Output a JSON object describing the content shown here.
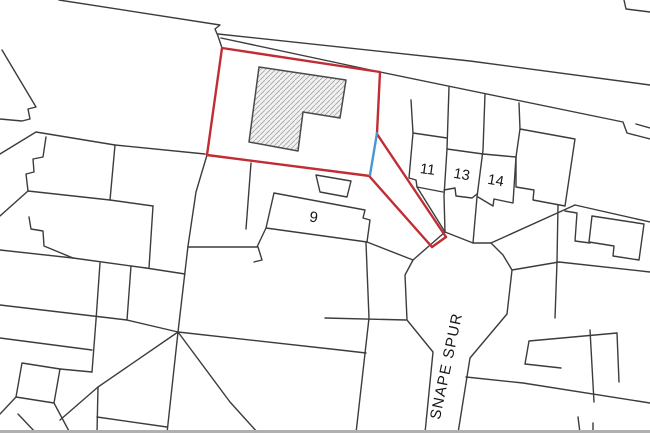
{
  "map": {
    "type": "site-location-plan",
    "width": 650,
    "height": 433,
    "colors": {
      "background": "#ffffff",
      "parcel_line": "#3c3c3c",
      "boundary_red": "#c02d33",
      "boundary_blue": "#4a97d2",
      "building_fill": "#f1f1f1",
      "building_hatch": "#a3a3a3",
      "building_outline": "#4a4a4a",
      "label_color": "#151515",
      "bottom_strip": "#b0b0b0"
    },
    "labels": [
      {
        "name": "house-number-9",
        "text": "9",
        "x": 313,
        "y": 222,
        "size": 15,
        "rot": 8,
        "spacing": 0
      },
      {
        "name": "house-number-11",
        "text": "11",
        "x": 427,
        "y": 174,
        "size": 14.5,
        "rot": 8,
        "spacing": 0
      },
      {
        "name": "house-number-13",
        "text": "13",
        "x": 461,
        "y": 179,
        "size": 14.5,
        "rot": 10,
        "spacing": 0
      },
      {
        "name": "house-number-14",
        "text": "14",
        "x": 495,
        "y": 185,
        "size": 14.5,
        "rot": 10,
        "spacing": 0
      },
      {
        "name": "street-name",
        "text": "SNAPE SPUR",
        "x": 451,
        "y": 367,
        "size": 15,
        "rot": -78,
        "spacing": 1.2
      }
    ],
    "red_boundary": [
      [
        [
          207,
          155
        ],
        [
          222,
          48
        ],
        [
          380,
          72
        ],
        [
          377,
          133
        ]
      ],
      [
        [
          370,
          176
        ],
        [
          207,
          155
        ]
      ],
      [
        [
          377,
          134
        ],
        [
          446,
          237
        ]
      ],
      [
        [
          370,
          177
        ],
        [
          432,
          247
        ]
      ],
      [
        [
          432,
          247
        ],
        [
          446,
          237
        ]
      ]
    ],
    "blue_segment": [
      [
        377,
        133
      ],
      [
        370,
        175
      ]
    ],
    "building": [
      [
        259,
        67
      ],
      [
        346,
        80
      ],
      [
        340,
        118
      ],
      [
        303,
        112
      ],
      [
        298,
        151
      ],
      [
        249,
        142
      ],
      [
        259,
        67
      ]
    ],
    "black_lines": [
      [
        [
          59,
          0
        ],
        [
          220,
          25
        ],
        [
          215,
          29
        ],
        [
          218,
          36
        ],
        [
          222,
          48
        ]
      ],
      [
        [
          218,
          34
        ],
        [
          470,
          61
        ],
        [
          650,
          85
        ]
      ],
      [
        [
          221,
          38
        ],
        [
          380,
          72
        ],
        [
          623,
          122
        ],
        [
          627,
          133
        ],
        [
          650,
          139
        ]
      ],
      [
        [
          636,
          124
        ],
        [
          650,
          128
        ]
      ],
      [
        [
          624,
          0
        ],
        [
          626,
          9
        ],
        [
          650,
          12
        ]
      ],
      [
        [
          2,
          50
        ],
        [
          36,
          107
        ],
        [
          28,
          109
        ],
        [
          30,
          119
        ],
        [
          22,
          121
        ],
        [
          0,
          119
        ]
      ],
      [
        [
          0,
          154
        ],
        [
          36,
          132
        ],
        [
          115,
          145
        ],
        [
          205,
          154
        ]
      ],
      [
        [
          207,
          155
        ],
        [
          196,
          192
        ],
        [
          188,
          246
        ],
        [
          178,
          332
        ],
        [
          167,
          433
        ]
      ],
      [
        [
          46,
          137
        ],
        [
          43,
          157
        ],
        [
          33,
          159
        ],
        [
          34,
          172
        ],
        [
          26,
          174
        ],
        [
          28,
          191
        ]
      ],
      [
        [
          28,
          191
        ],
        [
          110,
          200
        ],
        [
          153,
          206
        ]
      ],
      [
        [
          28,
          191
        ],
        [
          0,
          216
        ]
      ],
      [
        [
          153,
          206
        ],
        [
          149,
          268
        ]
      ],
      [
        [
          29,
          217
        ],
        [
          31,
          229
        ],
        [
          43,
          231
        ],
        [
          44,
          246
        ],
        [
          73,
          258
        ]
      ],
      [
        [
          0,
          250
        ],
        [
          73,
          258
        ]
      ],
      [
        [
          73,
          258
        ],
        [
          146,
          268
        ]
      ],
      [
        [
          146,
          268
        ],
        [
          185,
          274
        ]
      ],
      [
        [
          115,
          145
        ],
        [
          110,
          200
        ]
      ],
      [
        [
          100,
          263
        ],
        [
          96,
          320
        ]
      ],
      [
        [
          131,
          266
        ],
        [
          127,
          320
        ]
      ],
      [
        [
          0,
          305
        ],
        [
          127,
          320
        ]
      ],
      [
        [
          127,
          320
        ],
        [
          178,
          332
        ]
      ],
      [
        [
          96,
          320
        ],
        [
          92,
          372
        ]
      ],
      [
        [
          0,
          338
        ],
        [
          92,
          350
        ]
      ],
      [
        [
          178,
          332
        ],
        [
          98,
          387
        ],
        [
          60,
          420
        ]
      ],
      [
        [
          98,
          387
        ],
        [
          97,
          433
        ]
      ],
      [
        [
          178,
          332
        ],
        [
          230,
          402
        ],
        [
          258,
          433
        ]
      ],
      [
        [
          178,
          332
        ],
        [
          340,
          350
        ],
        [
          366,
          353
        ]
      ],
      [
        [
          22,
          363
        ],
        [
          60,
          369
        ],
        [
          54,
          403
        ],
        [
          16,
          397
        ],
        [
          22,
          363
        ]
      ],
      [
        [
          54,
          403
        ],
        [
          70,
          433
        ]
      ],
      [
        [
          16,
          397
        ],
        [
          0,
          414
        ]
      ],
      [
        [
          60,
          369
        ],
        [
          92,
          372
        ]
      ],
      [
        [
          18,
          414
        ],
        [
          36,
          433
        ]
      ],
      [
        [
          97,
          417
        ],
        [
          167,
          427
        ]
      ],
      [
        [
          251,
          163
        ],
        [
          246,
          229
        ]
      ],
      [
        [
          266,
          228
        ],
        [
          257,
          247
        ],
        [
          188,
          247
        ]
      ],
      [
        [
          258,
          247
        ],
        [
          262,
          260
        ],
        [
          254,
          262
        ]
      ],
      [
        [
          367,
          242
        ],
        [
          413,
          260
        ]
      ],
      [
        [
          366,
          243
        ],
        [
          369,
          318
        ],
        [
          356,
          433
        ]
      ],
      [
        [
          325,
          318
        ],
        [
          406,
          320
        ]
      ],
      [
        [
          413,
          260
        ],
        [
          405,
          275
        ],
        [
          407,
          320
        ],
        [
          433,
          352
        ],
        [
          425,
          433
        ]
      ],
      [
        [
          413,
          260
        ],
        [
          445,
          232
        ],
        [
          473,
          243
        ],
        [
          491,
          243
        ],
        [
          503,
          255
        ],
        [
          512,
          270
        ],
        [
          507,
          314
        ],
        [
          470,
          358
        ],
        [
          458,
          433
        ]
      ],
      [
        [
          449,
          87
        ],
        [
          447,
          149
        ],
        [
          444,
          196
        ],
        [
          445,
          232
        ]
      ],
      [
        [
          485,
          94
        ],
        [
          483,
          150
        ],
        [
          477,
          197
        ],
        [
          473,
          243
        ]
      ],
      [
        [
          411,
          100
        ],
        [
          413,
          133
        ]
      ],
      [
        [
          413,
          133
        ],
        [
          447,
          138
        ]
      ],
      [
        [
          413,
          133
        ],
        [
          409,
          178
        ],
        [
          416,
          180
        ],
        [
          417,
          187
        ],
        [
          443,
          192
        ]
      ],
      [
        [
          417,
          187
        ],
        [
          445,
          232
        ]
      ],
      [
        [
          447,
          149
        ],
        [
          483,
          154
        ]
      ],
      [
        [
          444,
          190
        ],
        [
          455,
          188
        ],
        [
          456,
          196
        ],
        [
          472,
          198
        ],
        [
          477,
          194
        ]
      ],
      [
        [
          483,
          154
        ],
        [
          516,
          157
        ]
      ],
      [
        [
          516,
          157
        ],
        [
          513,
          203
        ],
        [
          494,
          199
        ],
        [
          493,
          206
        ],
        [
          478,
          197
        ]
      ],
      [
        [
          516,
          157
        ],
        [
          520,
          129
        ],
        [
          575,
          139
        ],
        [
          565,
          206
        ],
        [
          533,
          200
        ],
        [
          534,
          190
        ],
        [
          516,
          187
        ],
        [
          516,
          157
        ]
      ],
      [
        [
          519,
          103
        ],
        [
          520,
          129
        ]
      ],
      [
        [
          491,
          243
        ],
        [
          575,
          205
        ]
      ],
      [
        [
          575,
          205
        ],
        [
          650,
          222
        ]
      ],
      [
        [
          565,
          211
        ],
        [
          577,
          213
        ],
        [
          575,
          241
        ],
        [
          590,
          243
        ]
      ],
      [
        [
          592,
          216
        ],
        [
          644,
          224
        ],
        [
          639,
          260
        ],
        [
          613,
          256
        ],
        [
          614,
          246
        ],
        [
          589,
          242
        ],
        [
          592,
          216
        ]
      ],
      [
        [
          512,
          270
        ],
        [
          559,
          262
        ],
        [
          650,
          272
        ]
      ],
      [
        [
          558,
          205
        ],
        [
          557,
          262
        ],
        [
          555,
          318
        ]
      ],
      [
        [
          466,
          377
        ],
        [
          523,
          383
        ],
        [
          650,
          403
        ]
      ],
      [
        [
          525,
          364
        ],
        [
          529,
          341
        ],
        [
          617,
          333
        ]
      ],
      [
        [
          590,
          330
        ],
        [
          594,
          402
        ]
      ],
      [
        [
          617,
          333
        ],
        [
          619,
          382
        ]
      ],
      [
        [
          525,
          364
        ],
        [
          561,
          368
        ]
      ],
      [
        [
          593,
          423
        ],
        [
          593,
          433
        ]
      ],
      [
        [
          578,
          417
        ],
        [
          580,
          433
        ]
      ],
      [
        [
          316,
          175
        ],
        [
          351,
          181
        ],
        [
          347,
          197
        ],
        [
          320,
          192
        ],
        [
          316,
          175
        ]
      ],
      [
        [
          274,
          193
        ],
        [
          365,
          210
        ],
        [
          363,
          218
        ],
        [
          370,
          220
        ],
        [
          367,
          242
        ],
        [
          266,
          228
        ],
        [
          274,
          193
        ]
      ]
    ]
  }
}
